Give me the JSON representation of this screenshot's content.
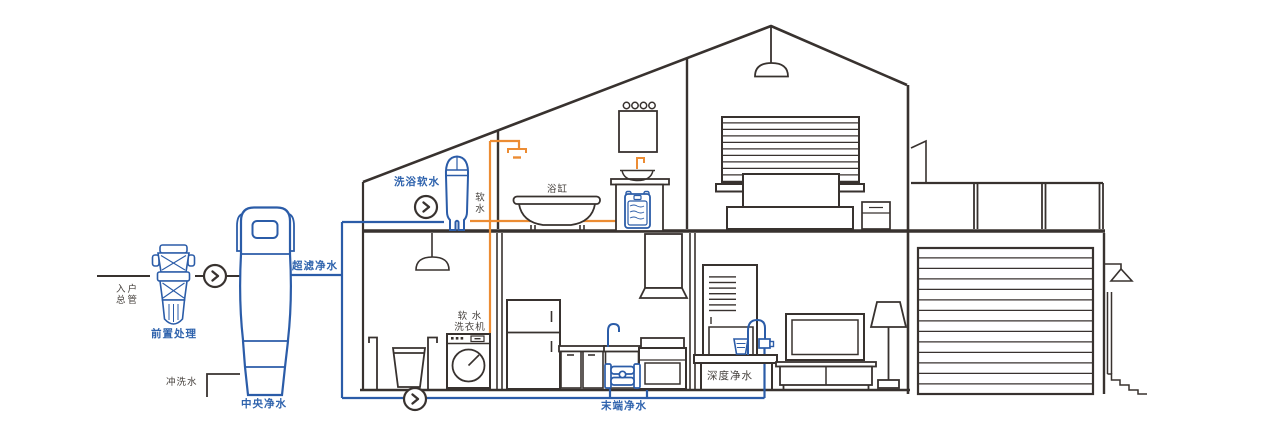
{
  "diagram_type": "whole-house water purification system in house cross-section",
  "colors": {
    "line_dark": "#38322f",
    "pipe_blue": "#2b5ca8",
    "pipe_orange": "#ec8c33",
    "label_blue": "#2f63ad",
    "label_dark": "#46413d",
    "background": "#ffffff"
  },
  "labels": {
    "inlet_main": {
      "line1": "入户",
      "line2": "总管"
    },
    "pre_treatment": "前置处理",
    "flush_water": "冲洗水",
    "central_purifier": "中央净水",
    "ultra_filtration": "超滤净水",
    "bath_softener": "洗浴软水",
    "soft_water": "软水",
    "bathtub": "浴缸",
    "soft_water_washer": {
      "line1": "软 水",
      "line2": "洗衣机"
    },
    "terminal_purifier": "末端净水",
    "deep_purifier": "深度净水"
  },
  "icons": [
    {
      "name": "flow-direction-icon",
      "glyph": "chevron-right-in-circle",
      "count": 3
    }
  ],
  "legend": {
    "blue_pipe_meaning": "purified water piping",
    "orange_pipe_meaning": "softened water piping"
  }
}
